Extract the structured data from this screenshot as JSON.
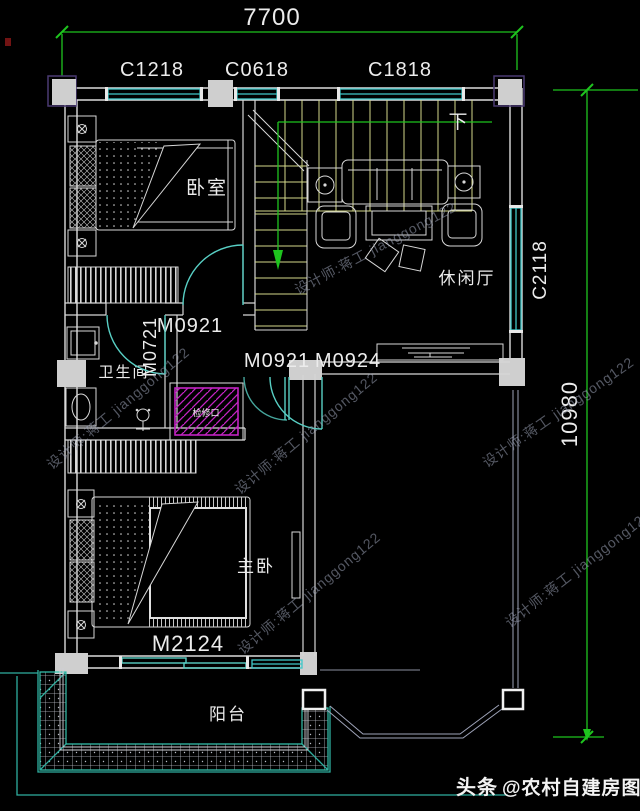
{
  "dims": {
    "width": "7700",
    "height": "10980"
  },
  "windows": {
    "c1218": "C1218",
    "c0618": "C0618",
    "c1818": "C1818",
    "c2118": "C2118"
  },
  "doors": {
    "m0921_a": "M0921",
    "m0921_b": "M0921",
    "m0924": "M0924",
    "m0721": "M0721",
    "m2124": "M2124"
  },
  "rooms": {
    "bedroom": "卧室",
    "lounge": "休闲厅",
    "bathroom": "卫生间",
    "master": "主卧",
    "balcony": "阳台"
  },
  "stairs": {
    "down": "下"
  },
  "notes": {
    "access_panel": "检修口"
  },
  "watermark": {
    "text": "设计师:蒋工 jianggong122"
  },
  "footer": {
    "brand": "头条",
    "handle": "@农村自建房图纸"
  },
  "colors": {
    "background": "#000000",
    "wall": "#dcdcdc",
    "window": "#41c8c9",
    "dimension": "#1ec41e",
    "stair": "#d4d98a",
    "door": "#58cfc4",
    "access_panel": "#c324c3",
    "balcony_edge": "#2fae9f",
    "watermark": "#9aa0b4"
  }
}
